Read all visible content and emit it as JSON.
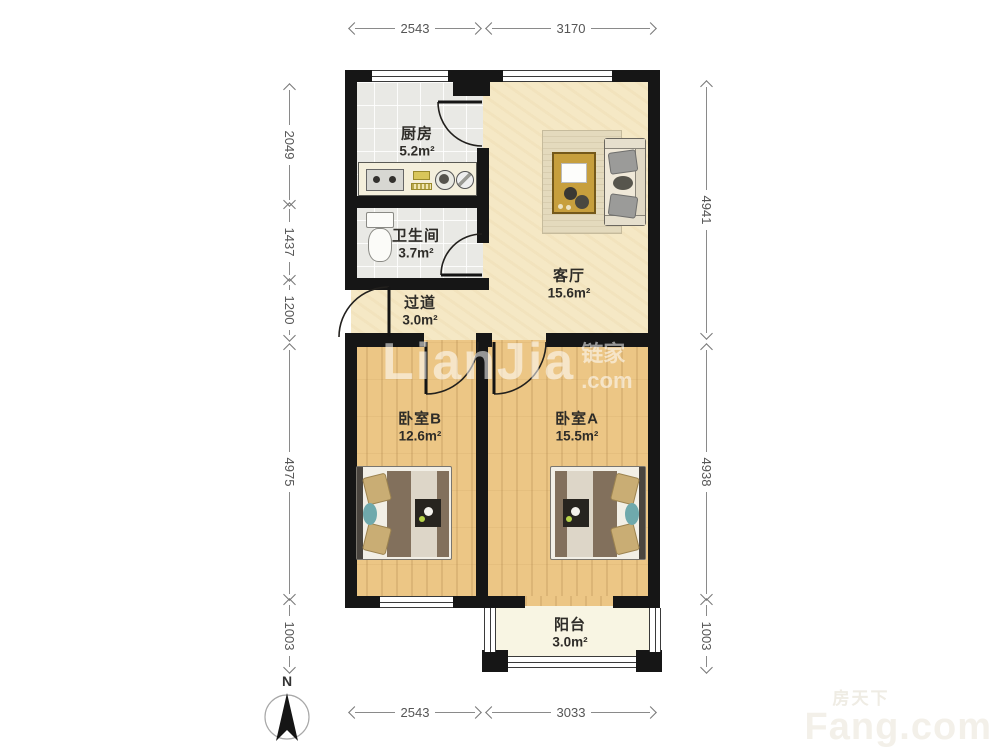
{
  "plan": {
    "rooms": [
      {
        "key": "kitchen",
        "name": "厨房",
        "area": "5.2m²"
      },
      {
        "key": "bathroom",
        "name": "卫生间",
        "area": "3.7m²"
      },
      {
        "key": "hallway",
        "name": "过道",
        "area": "3.0m²"
      },
      {
        "key": "living-room",
        "name": "客厅",
        "area": "15.6m²"
      },
      {
        "key": "bedroom-b",
        "name": "卧室B",
        "area": "12.6m²"
      },
      {
        "key": "bedroom-a",
        "name": "卧室A",
        "area": "15.5m²"
      },
      {
        "key": "balcony",
        "name": "阳台",
        "area": "3.0m²"
      }
    ],
    "dimensions_mm": {
      "top": [
        "2543",
        "3170"
      ],
      "bottom": [
        "2543",
        "3033"
      ],
      "left": [
        "2049",
        "1437",
        "1200",
        "4975",
        "1003"
      ],
      "right": [
        "4941",
        "4938",
        "1003"
      ]
    },
    "compass": {
      "label": "N"
    },
    "watermarks": {
      "center": {
        "brand": "LianJia",
        "cjk": "链家",
        "tld": ".com"
      },
      "corner": {
        "cjk": "房天下",
        "brand": "Fang.com"
      }
    },
    "palette": {
      "wall": "#161616",
      "tile": "#e9e9e5",
      "living_floor": "#f5e8c5",
      "wood_floor": "#ecc685",
      "balcony_floor": "#f8f5e3",
      "dim_text": "#555555"
    }
  }
}
